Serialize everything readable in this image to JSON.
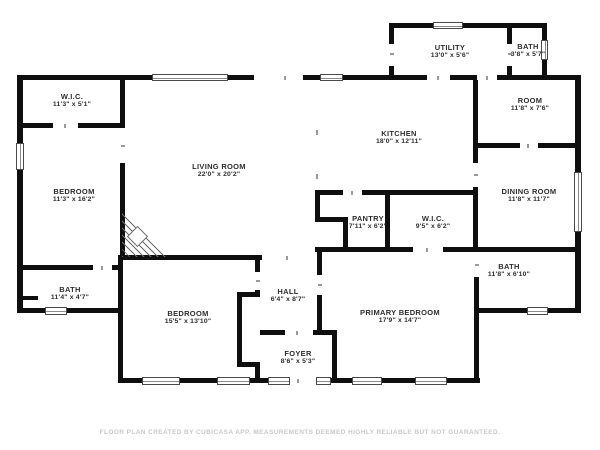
{
  "meta": {
    "footer": "FLOOR PLAN CREATED BY CUBICASA APP. MEASUREMENTS DEEMED HIGHLY RELIABLE BUT NOT GUARANTEED.",
    "footer_y": 429,
    "wall_color": "#0f0f0f",
    "background_color": "#ffffff",
    "label_color": "#2e2e2e",
    "footer_color": "#c9c9c9"
  },
  "rooms": [
    {
      "id": "wic-top-left",
      "name": "W.I.C.",
      "dims": "11'3\" x 5'1\"",
      "cx": 72,
      "cy": 101
    },
    {
      "id": "bedroom-top-left",
      "name": "BEDROOM",
      "dims": "11'3\" x 16'2\"",
      "cx": 74,
      "cy": 196
    },
    {
      "id": "living-room",
      "name": "LIVING ROOM",
      "dims": "22'0\" x 20'2\"",
      "cx": 219,
      "cy": 171
    },
    {
      "id": "kitchen",
      "name": "KITCHEN",
      "dims": "18'0\" x 12'11\"",
      "cx": 399,
      "cy": 138
    },
    {
      "id": "utility",
      "name": "UTILITY",
      "dims": "13'0\" x 5'6\"",
      "cx": 450,
      "cy": 52
    },
    {
      "id": "bath-top",
      "name": "BATH",
      "dims": "3'8\" x 5'7\"",
      "cx": 528,
      "cy": 51
    },
    {
      "id": "room",
      "name": "ROOM",
      "dims": "11'8\" x 7'6\"",
      "cx": 530,
      "cy": 105
    },
    {
      "id": "dining-room",
      "name": "DINING ROOM",
      "dims": "11'8\" x 11'7\"",
      "cx": 529,
      "cy": 196
    },
    {
      "id": "pantry",
      "name": "PANTRY",
      "dims": "7'11\" x 6'2\"",
      "cx": 368,
      "cy": 223
    },
    {
      "id": "wic-center",
      "name": "W.I.C.",
      "dims": "9'5\" x 6'2\"",
      "cx": 433,
      "cy": 223
    },
    {
      "id": "bath-east",
      "name": "BATH",
      "dims": "11'8\" x 6'10\"",
      "cx": 509,
      "cy": 271
    },
    {
      "id": "bath-left",
      "name": "BATH",
      "dims": "11'4\" x 4'7\"",
      "cx": 70,
      "cy": 294
    },
    {
      "id": "bedroom-bottom",
      "name": "BEDROOM",
      "dims": "15'5\" x 13'10\"",
      "cx": 188,
      "cy": 318
    },
    {
      "id": "hall",
      "name": "HALL",
      "dims": "6'4\" x 8'7\"",
      "cx": 288,
      "cy": 296
    },
    {
      "id": "primary-bedroom",
      "name": "PRIMARY BEDROOM",
      "dims": "17'9\" x 14'7\"",
      "cx": 400,
      "cy": 317
    },
    {
      "id": "foyer",
      "name": "FOYER",
      "dims": "8'6\" x 5'3\"",
      "cx": 298,
      "cy": 358
    }
  ],
  "walls": [
    [
      17,
      75,
      135,
      5
    ],
    [
      228,
      75,
      26,
      5
    ],
    [
      303,
      75,
      17,
      5
    ],
    [
      343,
      75,
      49,
      5
    ],
    [
      389,
      23,
      44,
      5
    ],
    [
      463,
      23,
      84,
      5
    ],
    [
      389,
      28,
      5,
      16
    ],
    [
      389,
      66,
      5,
      14
    ],
    [
      507,
      28,
      5,
      16
    ],
    [
      507,
      66,
      5,
      14
    ],
    [
      542,
      28,
      5,
      13
    ],
    [
      542,
      59,
      5,
      21
    ],
    [
      392,
      75,
      35,
      5
    ],
    [
      450,
      75,
      27,
      5
    ],
    [
      497,
      75,
      50,
      5
    ],
    [
      547,
      75,
      34,
      5
    ],
    [
      575,
      75,
      6,
      97
    ],
    [
      575,
      232,
      6,
      81
    ],
    [
      475,
      308,
      52,
      5
    ],
    [
      548,
      308,
      33,
      5
    ],
    [
      118,
      378,
      24,
      5
    ],
    [
      180,
      378,
      37,
      5
    ],
    [
      250,
      378,
      18,
      5
    ],
    [
      331,
      378,
      21,
      5
    ],
    [
      382,
      378,
      33,
      5
    ],
    [
      447,
      378,
      33,
      5
    ],
    [
      17,
      75,
      6,
      68
    ],
    [
      17,
      170,
      6,
      143
    ],
    [
      17,
      308,
      28,
      5
    ],
    [
      67,
      308,
      56,
      5
    ],
    [
      118,
      255,
      5,
      128
    ],
    [
      22,
      123,
      31,
      5
    ],
    [
      78,
      123,
      47,
      5
    ],
    [
      120,
      75,
      5,
      53
    ],
    [
      120,
      163,
      5,
      97
    ],
    [
      17,
      265,
      76,
      5
    ],
    [
      112,
      265,
      11,
      5
    ],
    [
      22,
      296,
      16,
      4
    ],
    [
      120,
      255,
      142,
      5
    ],
    [
      255,
      260,
      5,
      12
    ],
    [
      255,
      290,
      5,
      7
    ],
    [
      255,
      367,
      5,
      16
    ],
    [
      237,
      292,
      5,
      75
    ],
    [
      237,
      292,
      23,
      5
    ],
    [
      237,
      362,
      23,
      5
    ],
    [
      260,
      330,
      25,
      5
    ],
    [
      313,
      330,
      24,
      5
    ],
    [
      332,
      335,
      5,
      48
    ],
    [
      317,
      247,
      5,
      28
    ],
    [
      317,
      295,
      5,
      40
    ],
    [
      315,
      190,
      28,
      5
    ],
    [
      362,
      190,
      115,
      5
    ],
    [
      315,
      195,
      5,
      27
    ],
    [
      315,
      217,
      33,
      5
    ],
    [
      343,
      217,
      5,
      35
    ],
    [
      385,
      195,
      5,
      57
    ],
    [
      315,
      247,
      98,
      5
    ],
    [
      443,
      247,
      34,
      5
    ],
    [
      473,
      80,
      5,
      83
    ],
    [
      473,
      187,
      5,
      60
    ],
    [
      477,
      143,
      43,
      5
    ],
    [
      538,
      143,
      43,
      5
    ],
    [
      474,
      277,
      5,
      31
    ],
    [
      474,
      308,
      5,
      75
    ],
    [
      477,
      247,
      104,
      5
    ]
  ],
  "windows": [
    {
      "r": [
        152,
        74,
        76,
        7
      ],
      "o": "h"
    },
    {
      "r": [
        320,
        74,
        23,
        7
      ],
      "o": "h"
    },
    {
      "r": [
        433,
        22,
        30,
        7
      ],
      "o": "h"
    },
    {
      "r": [
        541,
        40,
        7,
        20
      ],
      "o": "v"
    },
    {
      "r": [
        574,
        172,
        8,
        60
      ],
      "o": "v"
    },
    {
      "r": [
        527,
        307,
        21,
        8
      ],
      "o": "h"
    },
    {
      "r": [
        142,
        377,
        38,
        8
      ],
      "o": "h"
    },
    {
      "r": [
        217,
        377,
        33,
        8
      ],
      "o": "h"
    },
    {
      "r": [
        268,
        377,
        22,
        8
      ],
      "o": "h"
    },
    {
      "r": [
        316,
        377,
        15,
        8
      ],
      "o": "h"
    },
    {
      "r": [
        352,
        377,
        30,
        8
      ],
      "o": "h"
    },
    {
      "r": [
        415,
        377,
        32,
        8
      ],
      "o": "h"
    },
    {
      "r": [
        16,
        143,
        8,
        27
      ],
      "o": "v"
    },
    {
      "r": [
        45,
        307,
        22,
        8
      ],
      "o": "h"
    }
  ],
  "ticks": [
    [
      284,
      76,
      2,
      4
    ],
    [
      64,
      124,
      2,
      4
    ],
    [
      121,
      145,
      4,
      2
    ],
    [
      101,
      266,
      2,
      4
    ],
    [
      256,
      280,
      4,
      2
    ],
    [
      286,
      256,
      2,
      4
    ],
    [
      296,
      331,
      2,
      4
    ],
    [
      318,
      284,
      4,
      2
    ],
    [
      351,
      191,
      2,
      4
    ],
    [
      426,
      248,
      2,
      4
    ],
    [
      475,
      264,
      4,
      2
    ],
    [
      474,
      174,
      4,
      2
    ],
    [
      527,
      144,
      2,
      4
    ],
    [
      437,
      76,
      2,
      4
    ],
    [
      390,
      53,
      4,
      2
    ],
    [
      508,
      53,
      4,
      2
    ],
    [
      297,
      379,
      2,
      4
    ],
    [
      316,
      130,
      2,
      5
    ],
    [
      316,
      174,
      2,
      5
    ],
    [
      486,
      76,
      2,
      4
    ]
  ],
  "fireplace": {
    "x": 122,
    "y": 211,
    "w": 46,
    "h": 46,
    "diamond": {
      "x": 130,
      "y": 229,
      "size": 13
    }
  }
}
